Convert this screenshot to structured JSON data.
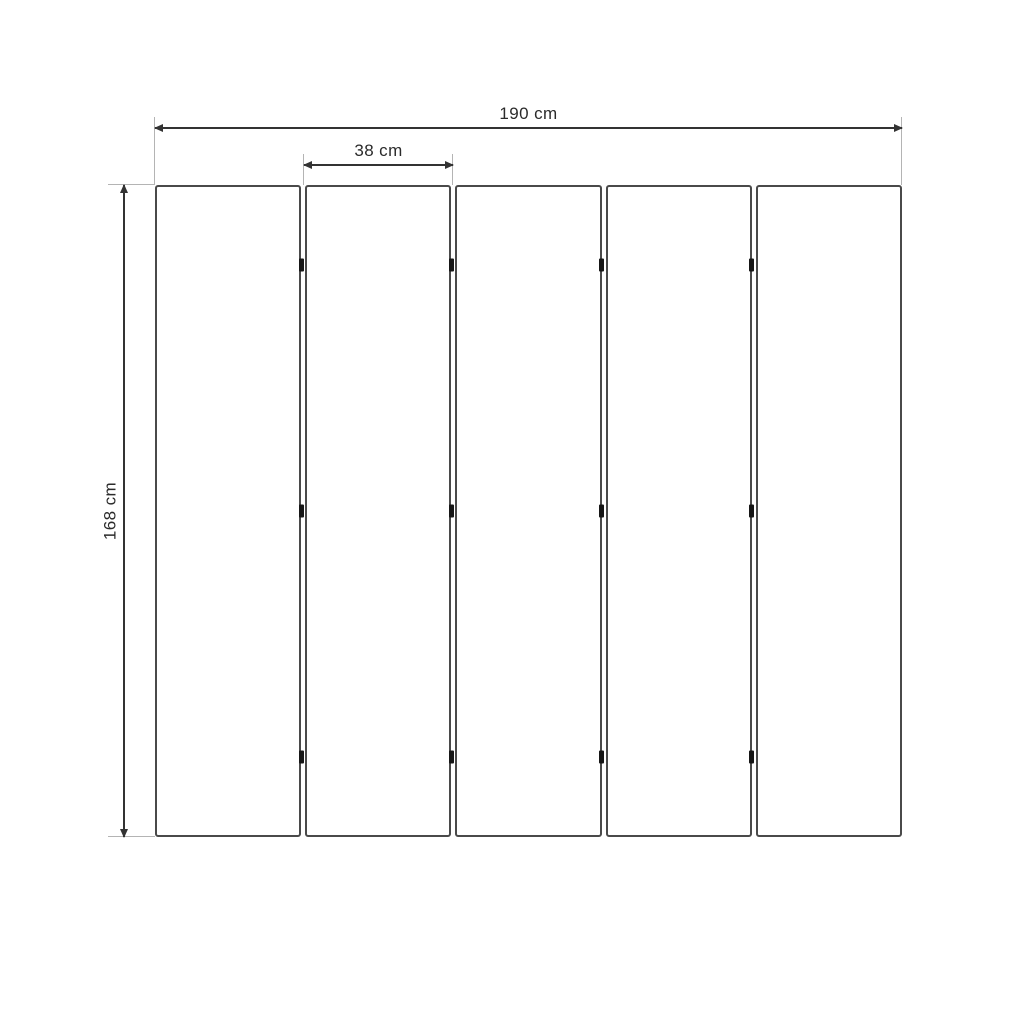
{
  "diagram": {
    "panel_count": 5,
    "hinge_joints": 4,
    "hinges_per_joint": 3,
    "hinge_positions_pct": [
      12,
      50,
      88
    ],
    "dimensions": {
      "total_width": {
        "label": "190 cm",
        "value": 190,
        "unit": "cm",
        "orientation": "horizontal"
      },
      "panel_width": {
        "label": "38 cm",
        "value": 38,
        "unit": "cm",
        "orientation": "horizontal"
      },
      "total_height": {
        "label": "168 cm",
        "value": 168,
        "unit": "cm",
        "orientation": "vertical"
      }
    },
    "colors": {
      "background": "#ffffff",
      "dimension_line": "#333333",
      "extension_line": "#b4b4b4",
      "panel_border": "#4a4a4a",
      "hinge": "#161616",
      "text": "#2b2b2b"
    }
  }
}
